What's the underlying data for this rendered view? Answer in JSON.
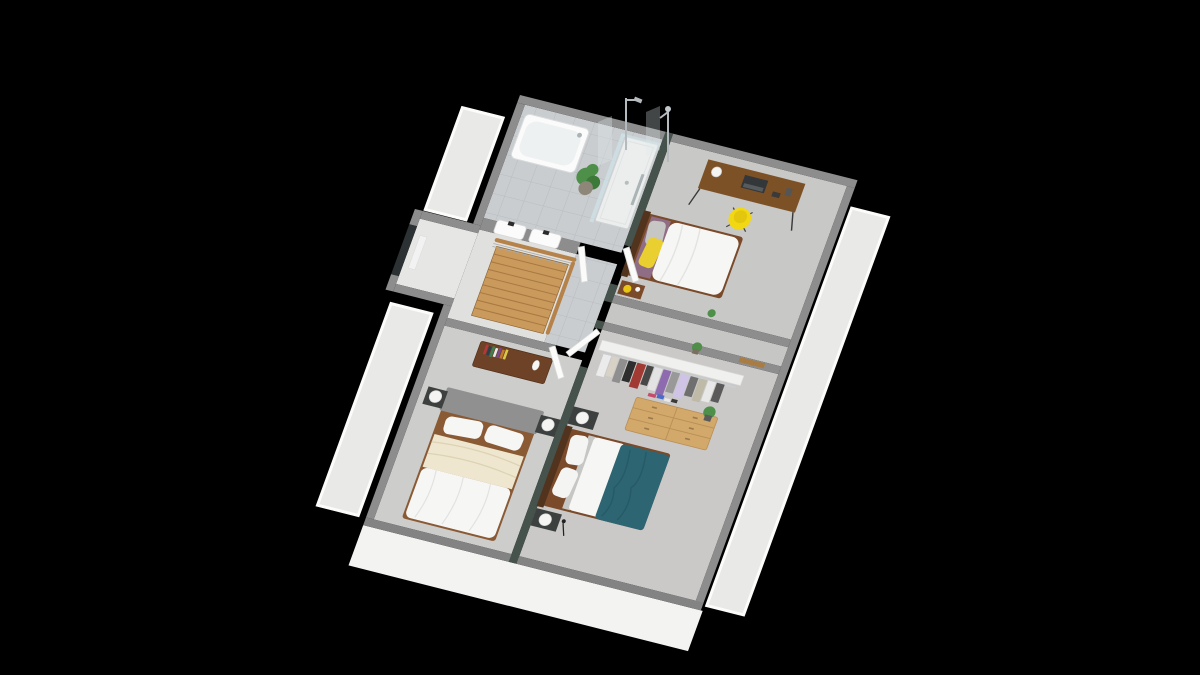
{
  "scene": {
    "title": "",
    "description": "Isometric 3D render of an upper-storey floor plan on a black background: tiled bathroom with bathtub, walk-in shower, twin washbasins and a potted plant; landing with wooden staircase and railing; bedroom with desk, laptop, yellow chair and single bed with yellow pillow; bedroom with white double bed, grey headboard and cream throw; bedroom with teal duvet double bed, open wardrobe rack and light wood dresser; white roof terraces along the left and right sides and a white front facade.",
    "view": "isometric",
    "background": "#000000"
  },
  "palette": {
    "background": "#000000",
    "wall": "#8d8d8d",
    "wall_dark": "#838383",
    "accent_wall": "#46524c",
    "tile": "#c9cdd0",
    "tile_line": "#b9bdc0",
    "carpet_light": "#c8c8c6",
    "carpet": "#cdcdcb",
    "carpet_warm": "#cac9c7",
    "corridor": "#c6c6c4",
    "stair_floor": "#e0e0de",
    "wing_floor": "#e6e6e4",
    "terrace": "#e9e9e7",
    "parapet": "#fcfcfa",
    "facade": "#f3f3f1",
    "wood_dark": "#6e4226",
    "wood": "#7a4a2a",
    "wood_deep": "#52331d",
    "wood_mid": "#8a5a35",
    "wood_light": "#d2a86b",
    "wood_light_line": "#b98f55",
    "stair_wood": "#c99a5c",
    "stair_line": "#8a5f2e",
    "rail_wood": "#b5824a",
    "desk_wood": "#7d5126",
    "white_soft": "#f6f6f4",
    "white_fixture": "#fbfbfb",
    "tub_inner": "#eef1f1",
    "shower_tray": "#eceeee",
    "cream": "#eee6cf",
    "cream_line": "#ddd2b4",
    "gray_headboard": "#909090",
    "plum": "#8f6d84",
    "teal": "#2d6573",
    "teal_line": "#265a66",
    "yellow": "#f2d713",
    "yellow_deep": "#e3c70f",
    "yellow_soft": "#e9cf2f",
    "yellow_lamp": "#e9c614",
    "plant": "#4e8f49",
    "plant_dark": "#3d7a3a",
    "pot": "#8e8779",
    "chrome": "#aab3b6",
    "glass": "#cfe2e8",
    "glass_pane": "#dfe9ec",
    "nightstand": "#3c403e",
    "lamp_white": "#f4f4f2",
    "window": "#2c3134",
    "door": "#fbfbfa",
    "door_edge": "#d8d8d8",
    "half_wall": "#f0f0ee",
    "rack_rail": "#c9ced1",
    "pillow_gray": "#c6c6c4",
    "dark_item": "#33373a",
    "radiator": "#f2f2f2",
    "vase": "#f6f6f4",
    "fold_line": "#e2e2e0"
  },
  "rooms": [
    {
      "id": "bathroom",
      "label": "bathroom",
      "floor": "grey tile",
      "items": [
        "bathtub",
        "walk-in shower",
        "twin washbasins",
        "potted plant"
      ]
    },
    {
      "id": "landing",
      "label": "landing",
      "floor": "grey tile",
      "items": [
        "wooden staircase",
        "wood railing",
        "stairwell window"
      ]
    },
    {
      "id": "bedroom-1",
      "label": "bedroom 1",
      "floor": "grey carpet",
      "items": [
        "desk",
        "laptop",
        "desk lamp",
        "yellow chair",
        "single bed",
        "yellow pillow",
        "plum throw",
        "nightstand",
        "yellow lamp"
      ]
    },
    {
      "id": "bedroom-2",
      "label": "bedroom 2",
      "floor": "grey carpet",
      "items": [
        "double bed",
        "grey headboard",
        "cream throw",
        "two nightstands",
        "two white lamps",
        "chest of drawers",
        "books",
        "vase"
      ]
    },
    {
      "id": "bedroom-3",
      "label": "bedroom 3",
      "floor": "grey carpet",
      "items": [
        "double bed",
        "teal duvet",
        "two nightstands",
        "two white lamps",
        "light wood dresser",
        "potted plant",
        "open wardrobe rack"
      ]
    }
  ],
  "exterior": {
    "terraces": [
      "left upper terrace",
      "left lower terrace",
      "right terrace"
    ],
    "facade": "white front facade",
    "window": "stairwell picture window"
  },
  "wardrobe": {
    "clothes_colors": [
      "#ebebeb",
      "#d8d1c5",
      "#8f8f8f",
      "#2e2e2e",
      "#a23a34",
      "#474747",
      "#e3e3e3",
      "#8e6bae",
      "#999999",
      "#cfc3e6",
      "#6f6f6f",
      "#bfb9a8",
      "#e8e8e8",
      "#5a5a5a"
    ]
  },
  "books": {
    "colors": [
      "#b03a3a",
      "#2c3e50",
      "#3f7f4f",
      "#e8e8e8",
      "#7a4a8f",
      "#c47a2a",
      "#d8c84a"
    ]
  },
  "pile": {
    "colors": [
      "#c84a6b",
      "#4a6bc8",
      "#e8e8e8",
      "#3a3a3a"
    ]
  }
}
